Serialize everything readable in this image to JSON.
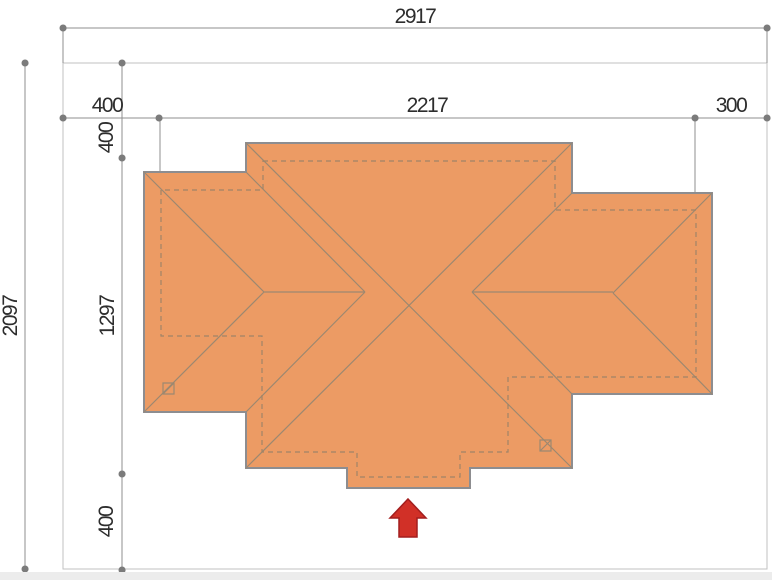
{
  "meta": {
    "drawing_type": "house roof plan with plot dimension lines",
    "canvas": {
      "width": 772,
      "height": 580
    }
  },
  "colors": {
    "background": "#ffffff",
    "roof_fill": "#ec9b64",
    "roof_stroke": "#8d8d90",
    "roof_inner_lines": "#9c8870",
    "building_dashed": "#a08467",
    "dimension_line": "#8f8f8f",
    "dimension_dot": "#7b7b7b",
    "site_boundary": "#c2c2c2",
    "text": "#2d2d2d",
    "entrance_arrow": "#d13027",
    "footer_strip": "#ececec"
  },
  "dimensions": {
    "overall_width": {
      "label": "2917"
    },
    "overall_height": {
      "label": "2097"
    },
    "width_segments": [
      {
        "label": "400"
      },
      {
        "label": "2217"
      },
      {
        "label": "300"
      }
    ],
    "height_segments": [
      {
        "label": "400"
      },
      {
        "label": "1297"
      },
      {
        "label": "400"
      }
    ]
  },
  "drawing": {
    "roof_outline_points": "246,143 572,143 572,193 712,193 712,394 572,394 572,468 470,468 470,488 347,488 347,468 246,468 246,412 144,412 144,172 246,172",
    "building_outline_points": "263,161 555,161 555,210 696,210 696,377 508,377 508,452 460,452 460,477 357,477 357,452 262,452 262,336 161,336 161,190 263,190",
    "roof_lines_path": "M144 172L264 292 M144 412L264 292 M264 292H365 M246 172L365 292 M246 412L365 292 M712 193L613 293 M712 394L613 293 M472 292H613 M572 193L472 292 M572 394L472 292 M246 143L572 468 M572 143L246 468",
    "dimension_lines_path": "M63 28H767 M25 63V569 M63 118H767 M122 63V570 M63 28V63 M767 28V63 M160 118V190 M695 118V210",
    "dimension_dots_path": "M63 28h.1 M767 28h.1 M25 63h.1 M25 569h.1 M63 118h.1 M159 118h.1 M695 118h.1 M767 118h.1 M122 63h.1 M122 158h.1 M122 474h.1 M122 570h.1",
    "chimneys_path": "M163 383h11v11h-11z M163 394l11 -11 M540 440h11v11h-11z M540 451l11 -11",
    "entrance_arrow_points": "408,499 426,518 417,518 417,537 399,537 399,518 390,518"
  }
}
